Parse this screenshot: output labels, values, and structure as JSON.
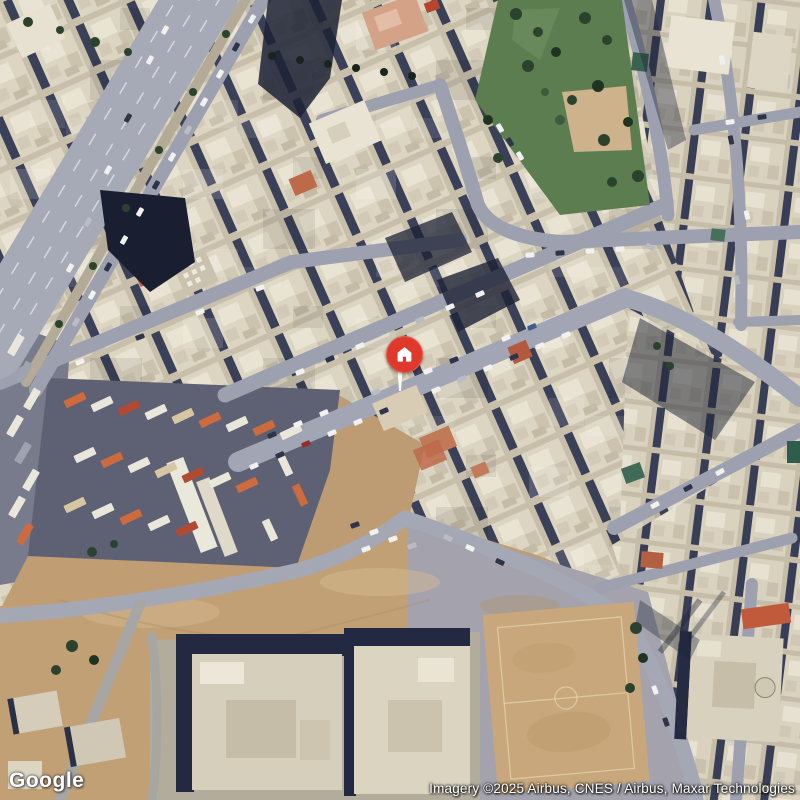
{
  "map": {
    "view": "satellite",
    "scene": "dense desert-city district: diagonal multi-lane highway top-left, triangular tree park top-right, truck depot and sand lots lower-left, dirt football field lower-right, red home pin on central street"
  },
  "marker": {
    "label": "Property location",
    "icon": "home",
    "color": "#df392c",
    "icon_color": "#ffffff",
    "stem_color": "#fdfdfb"
  },
  "branding": {
    "logo_text": "Google"
  },
  "attribution": {
    "text": "Imagery ©2025 Airbus, CNES / Airbus, Maxar Technologies"
  },
  "palette": {
    "road": "#9da0af",
    "highway": "#a6a9b6",
    "building_light": "#dcd5c2",
    "building_base": "#c8bfab",
    "shadow": "#232941",
    "sand": "#c09d72",
    "park_green": "#5c7d50",
    "field_dirt": "#c7a77b",
    "depot_asphalt": "#5e6174",
    "truck_orange": "#cd6a3e"
  }
}
